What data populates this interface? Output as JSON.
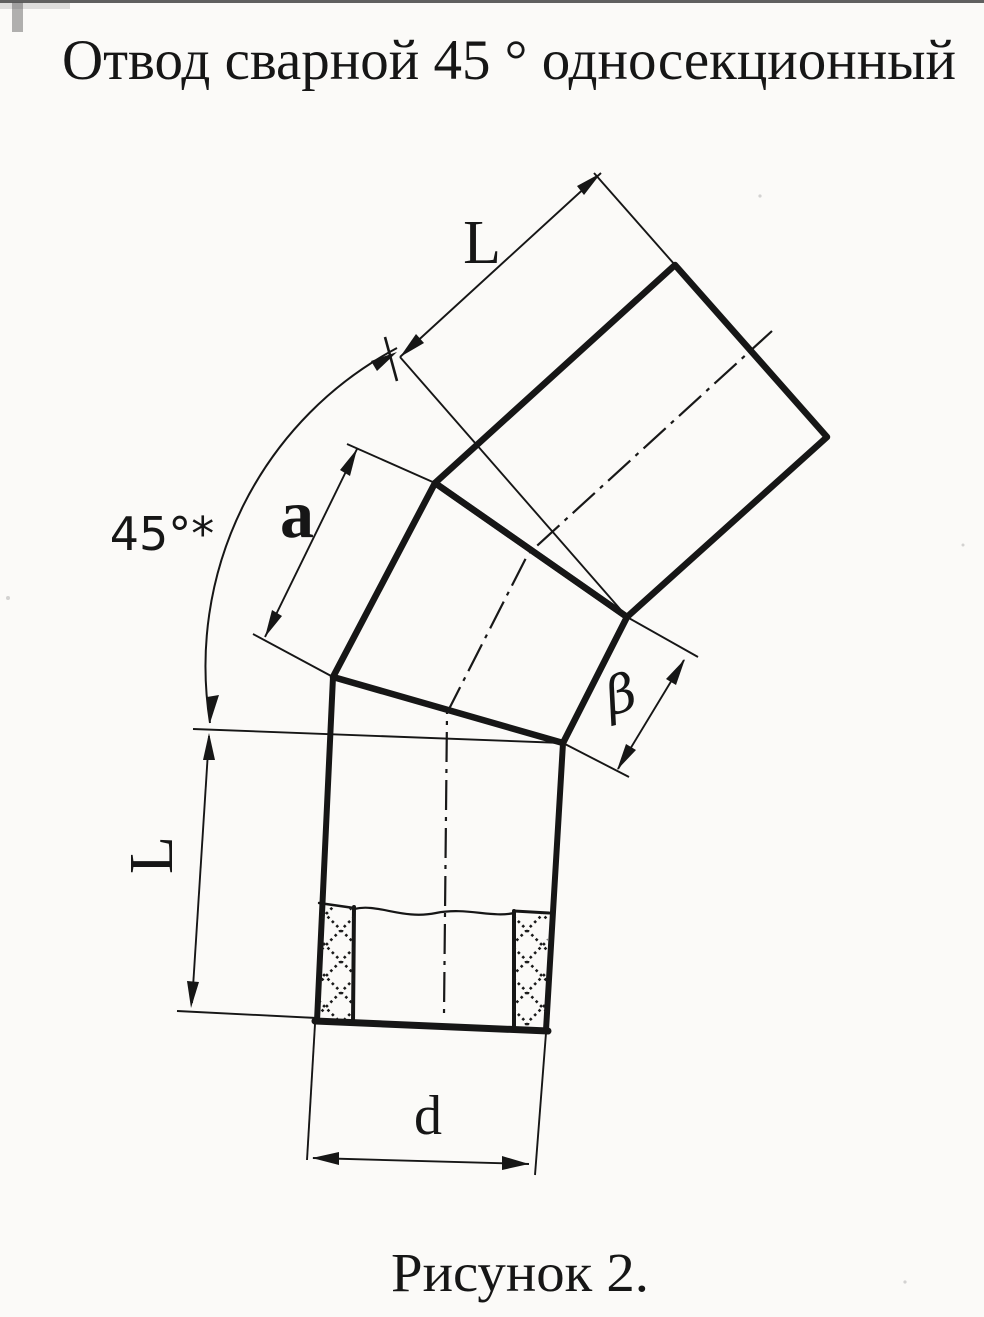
{
  "figure": {
    "title": "Отвод сварной 45 ° односекционный",
    "caption": "Рисунок 2.",
    "labels": {
      "upper_pipe_length": "L",
      "bend_angle": "45°*",
      "middle_section_outer_width": "a",
      "middle_section_end_width": "β",
      "lower_pipe_length": "L",
      "pipe_diameter": "d"
    },
    "colors": {
      "ink": "#161616",
      "paper": "#fbfaf8"
    }
  }
}
